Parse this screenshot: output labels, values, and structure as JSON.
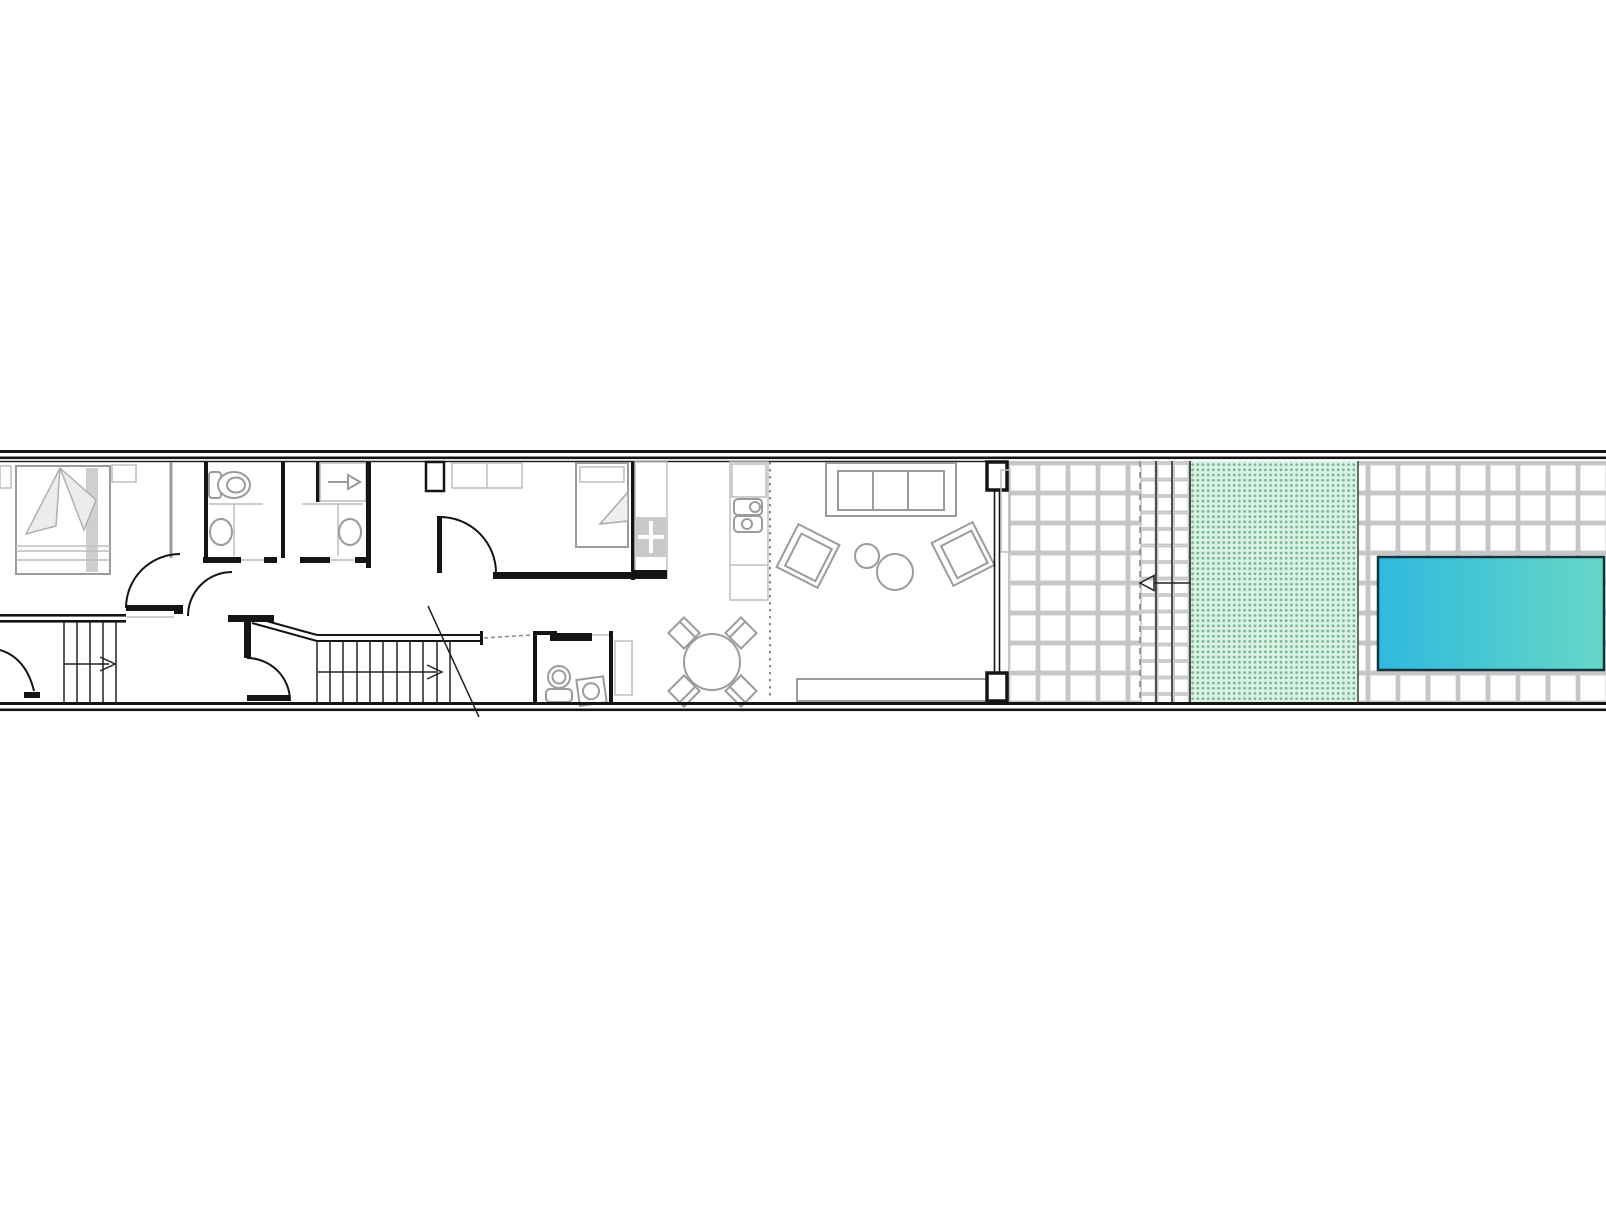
{
  "document": {
    "type": "architectural-floor-plan",
    "description": "Long narrow row-house ground floor plan with rear patio, lawn strip and swimming pool",
    "background": "#ffffff",
    "visible_text": []
  },
  "colors": {
    "wall": "#141414",
    "thin": "#222222",
    "furn": "#9b9b9b",
    "light": "#bdbdbd",
    "tile": "#c6c6c6",
    "lawn_bg": "#d8f2e3",
    "lawn_dot": "#74b291",
    "pool_from": "#2eb9de",
    "pool_to": "#66d7c6",
    "dash": "#888888"
  },
  "rooms": [
    {
      "id": "bedroom-1",
      "name": "master bedroom",
      "fixtures": [
        "double-bed",
        "nightstand-left",
        "nightstand-right",
        "door-swing"
      ]
    },
    {
      "id": "bathroom-1",
      "name": "bathroom 1",
      "fixtures": [
        "toilet",
        "vanity-counter",
        "sink"
      ]
    },
    {
      "id": "bathroom-2",
      "name": "bathroom 2",
      "fixtures": [
        "shower-with-drain-arrow",
        "vanity-counter",
        "sink"
      ]
    },
    {
      "id": "hallway",
      "name": "hall / corridor",
      "fixtures": [
        "door-swing",
        "door-swing",
        "door-swing",
        "entry-door-swing"
      ]
    },
    {
      "id": "stairs-1",
      "name": "staircase lower",
      "fixtures": [
        "5 treads",
        "direction-arrow-right"
      ]
    },
    {
      "id": "stairs-2",
      "name": "staircase upper",
      "fixtures": [
        "11 treads",
        "direction-arrow-right",
        "section-break-line"
      ]
    },
    {
      "id": "bedroom-2",
      "name": "bedroom 2",
      "fixtures": [
        "wardrobe",
        "single-bed",
        "door-swing"
      ]
    },
    {
      "id": "kitchen",
      "name": "kitchen",
      "fixtures": [
        "counter-left",
        "cooktop-4burner",
        "counter-right",
        "double-sink"
      ]
    },
    {
      "id": "wc",
      "name": "guest WC",
      "fixtures": [
        "toilet",
        "corner-sink",
        "sliding-door",
        "side-cabinet"
      ]
    },
    {
      "id": "dining",
      "name": "dining area",
      "fixtures": [
        "round-table",
        "chair x4"
      ]
    },
    {
      "id": "living",
      "name": "living room",
      "fixtures": [
        "sofa-3-seat",
        "armchair-left",
        "armchair-right",
        "coffee-table-small",
        "coffee-table-large",
        "sideboard",
        "glass-wall-piers"
      ]
    }
  ],
  "outdoor": {
    "patio_near": {
      "name": "tiled patio",
      "tile_grid_px": 30
    },
    "gate_strip": {
      "name": "fence / gate strip",
      "elements": [
        "dashed-property-line",
        "fence-line x2",
        "entrance-arrow-left"
      ]
    },
    "lawn": {
      "name": "lawn",
      "pattern": "green dot hatch"
    },
    "patio_far": {
      "name": "pool deck",
      "tile_grid_px": 30
    },
    "pool": {
      "name": "swimming pool",
      "gradient": "cyan-blue to teal-green"
    }
  },
  "annotations": {
    "entrance_arrow_direction": "left",
    "stair_arrow_direction": "right",
    "shower_drain_arrow_direction": "right"
  }
}
